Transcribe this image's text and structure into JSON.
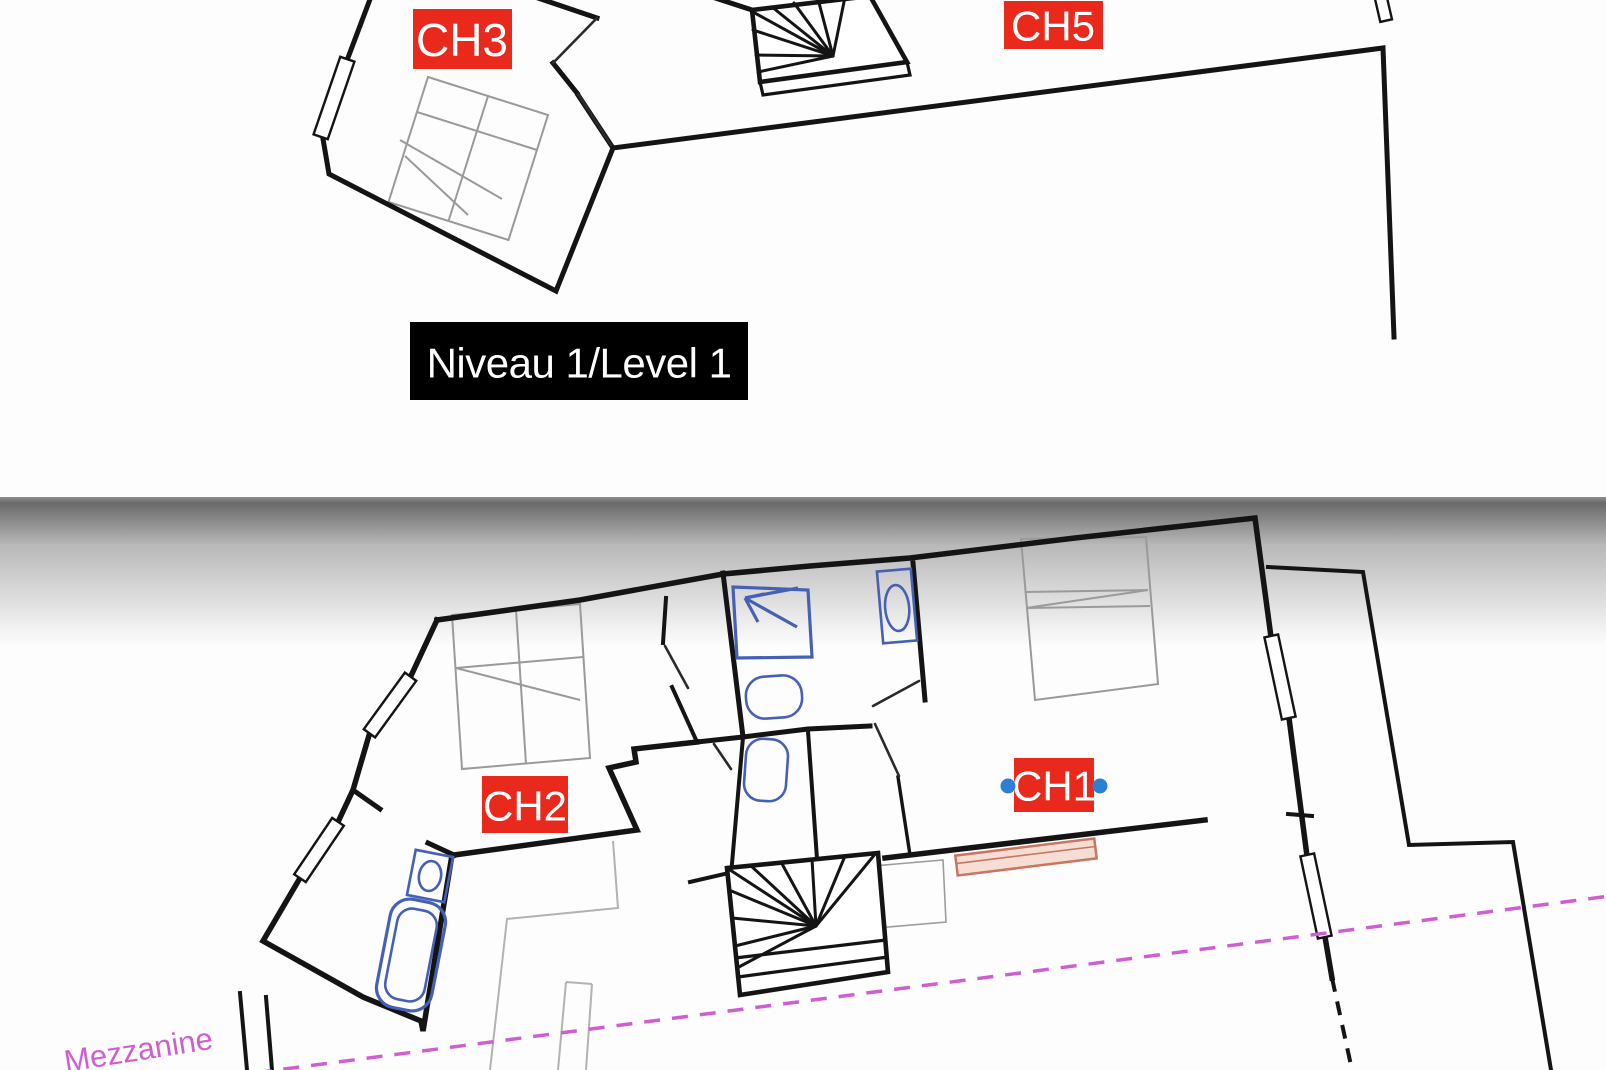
{
  "colors": {
    "wall-black": "#141414",
    "label-red": "#e8291c",
    "label-text": "#ffffff",
    "level-box-bg": "#000000",
    "level-box-text": "#ffffff",
    "fixture-blue": "#4560b5",
    "handle-blue": "#2d7fd3",
    "magenta": "#cf5fd0",
    "radiator-fill": "#f7ded5",
    "radiator-stroke": "#c8765f",
    "furniture-gray": "#9a9a9a"
  },
  "level1": {
    "title": "Niveau 1/Level 1",
    "room_labels": [
      {
        "id": "ch3",
        "label": "CH3"
      },
      {
        "id": "ch5",
        "label": "CH5"
      }
    ]
  },
  "mezzanine": {
    "title": "Mezzanine",
    "room_labels": [
      {
        "id": "ch2",
        "label": "CH2"
      },
      {
        "id": "ch1",
        "label": "CH1",
        "selected": true
      }
    ]
  }
}
